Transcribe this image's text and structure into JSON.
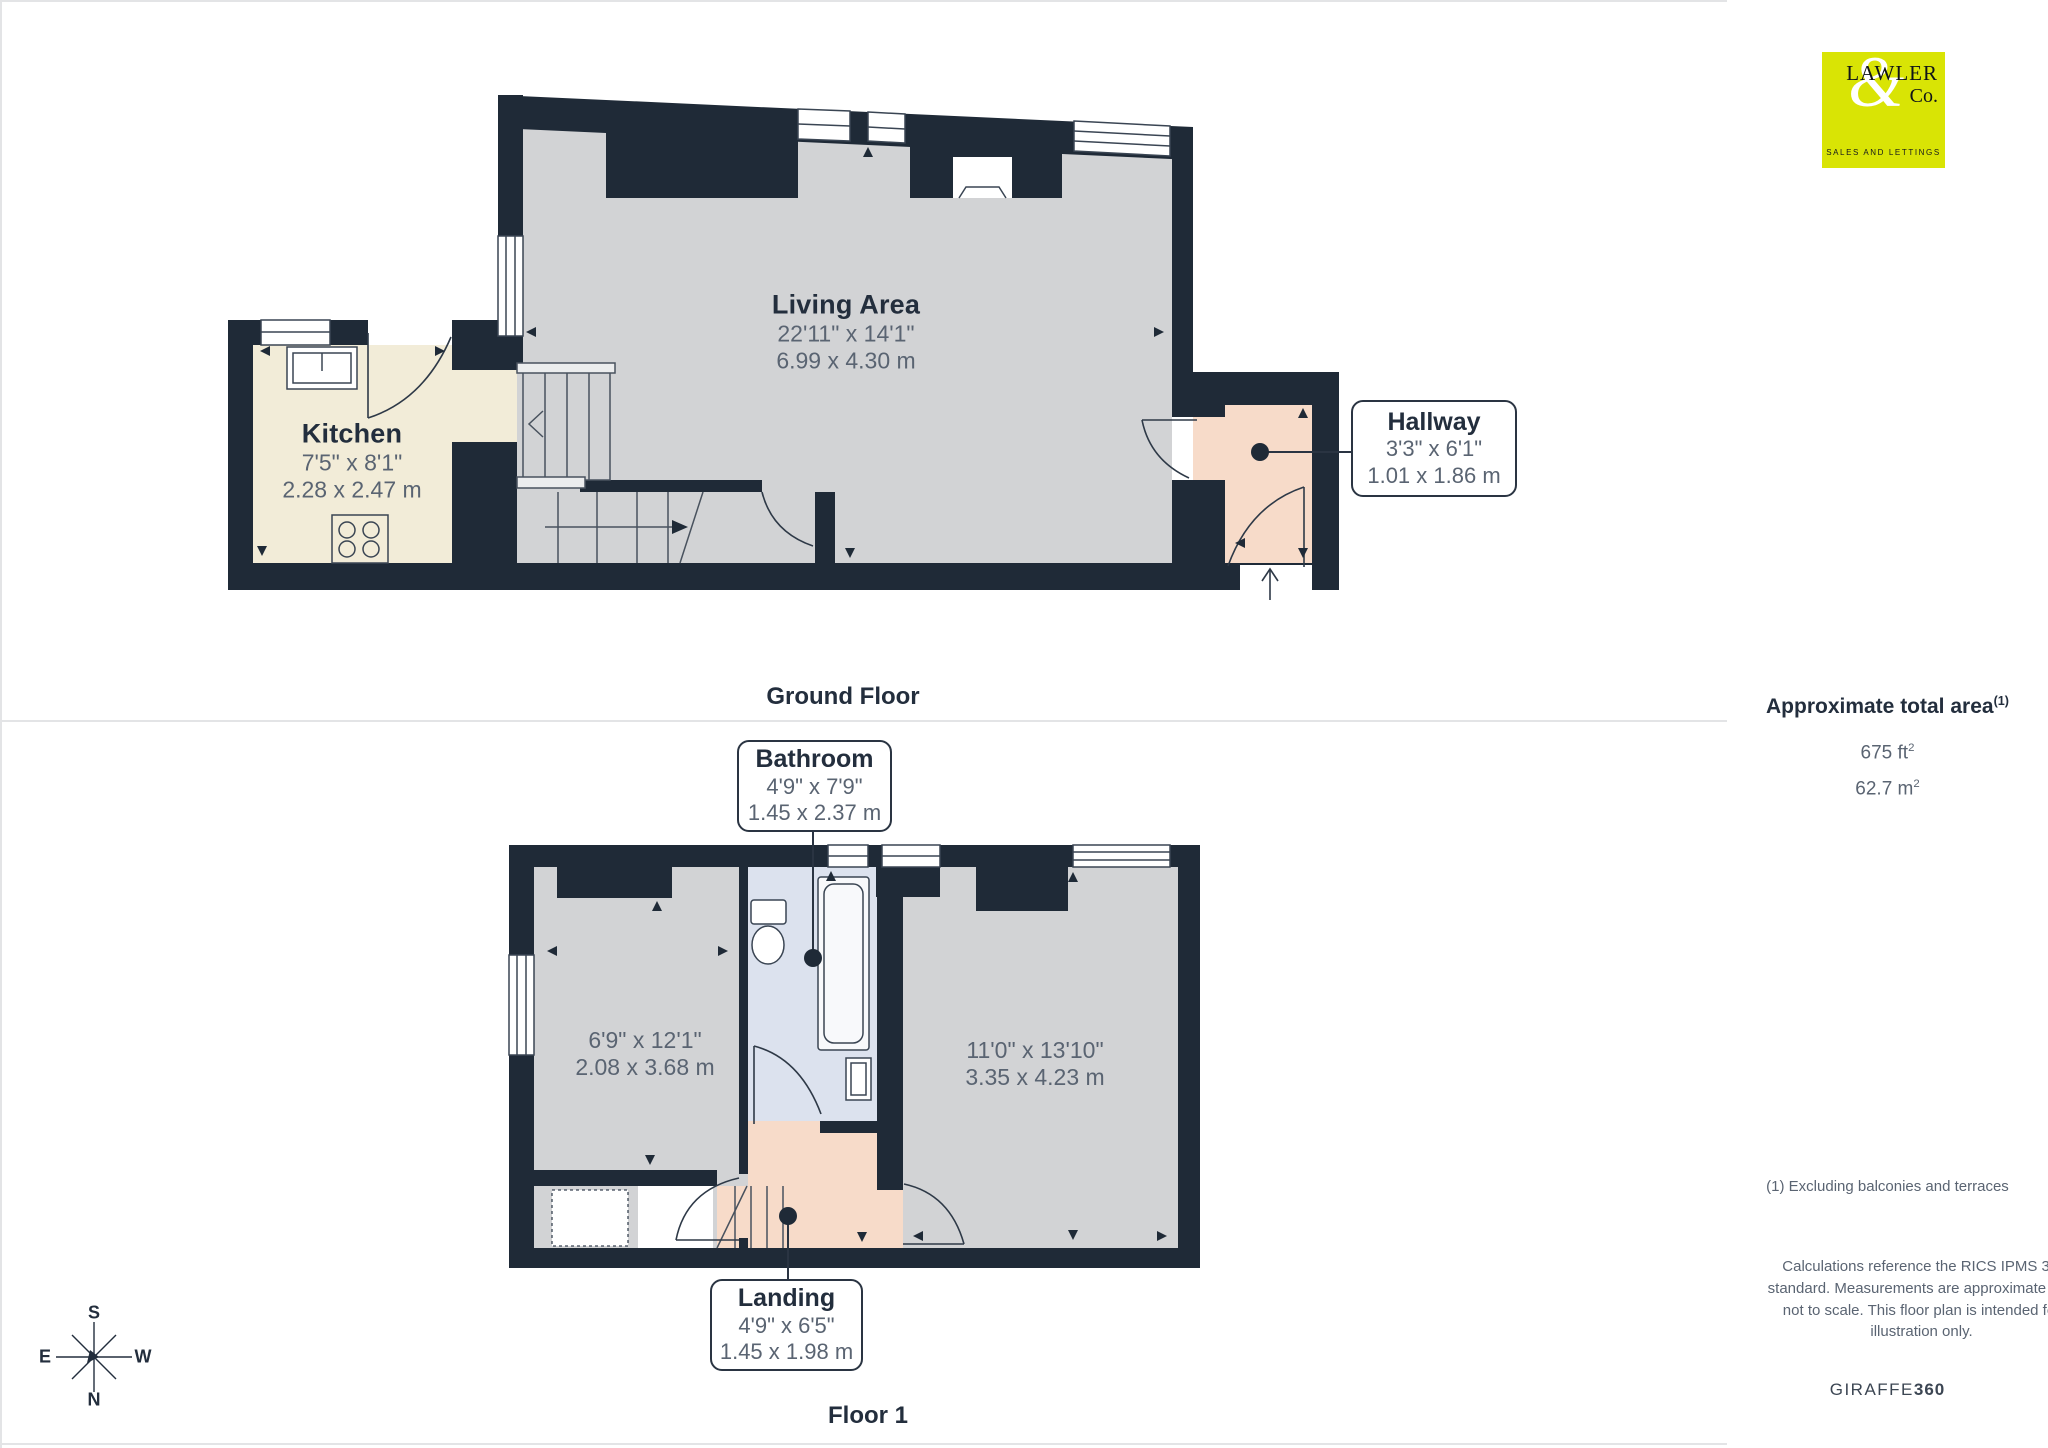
{
  "logo": {
    "name": "LAWLER",
    "amp": "&",
    "co": "Co.",
    "tagline": "SALES AND LETTINGS"
  },
  "sidebar": {
    "area_title": "Approximate total area",
    "area_title_sup": "(1)",
    "area_ft_value": "675 ft",
    "area_ft_sup": "2",
    "area_m_value": "62.7 m",
    "area_m_sup": "2",
    "footnote": "(1) Excluding balconies and terraces",
    "disclaimer": "Calculations reference the RICS IPMS 3C standard. Measurements are approximate and not to scale. This floor plan is intended for illustration only.",
    "brand": "GIRAFFE",
    "brand_bold": "360"
  },
  "ground_floor": {
    "caption": "Ground Floor",
    "living": {
      "title": "Living Area",
      "imperial": "22'11\" x 14'1\"",
      "metric": "6.99 x 4.30 m"
    },
    "kitchen": {
      "title": "Kitchen",
      "imperial": "7'5\" x 8'1\"",
      "metric": "2.28 x 2.47 m"
    },
    "hallway": {
      "title": "Hallway",
      "imperial": "3'3\" x 6'1\"",
      "metric": "1.01 x 1.86 m"
    }
  },
  "floor1": {
    "caption": "Floor 1",
    "bathroom": {
      "title": "Bathroom",
      "imperial": "4'9\" x 7'9\"",
      "metric": "1.45 x 2.37 m"
    },
    "bedroom1": {
      "imperial": "6'9\" x 12'1\"",
      "metric": "2.08 x 3.68 m"
    },
    "bedroom2": {
      "imperial": "11'0\" x 13'10\"",
      "metric": "3.35 x 4.23 m"
    },
    "landing": {
      "title": "Landing",
      "imperial": "4'9\" x 6'5\"",
      "metric": "1.45 x 1.98 m"
    }
  },
  "compass": {
    "n": "N",
    "s": "S",
    "e": "E",
    "w": "W"
  }
}
